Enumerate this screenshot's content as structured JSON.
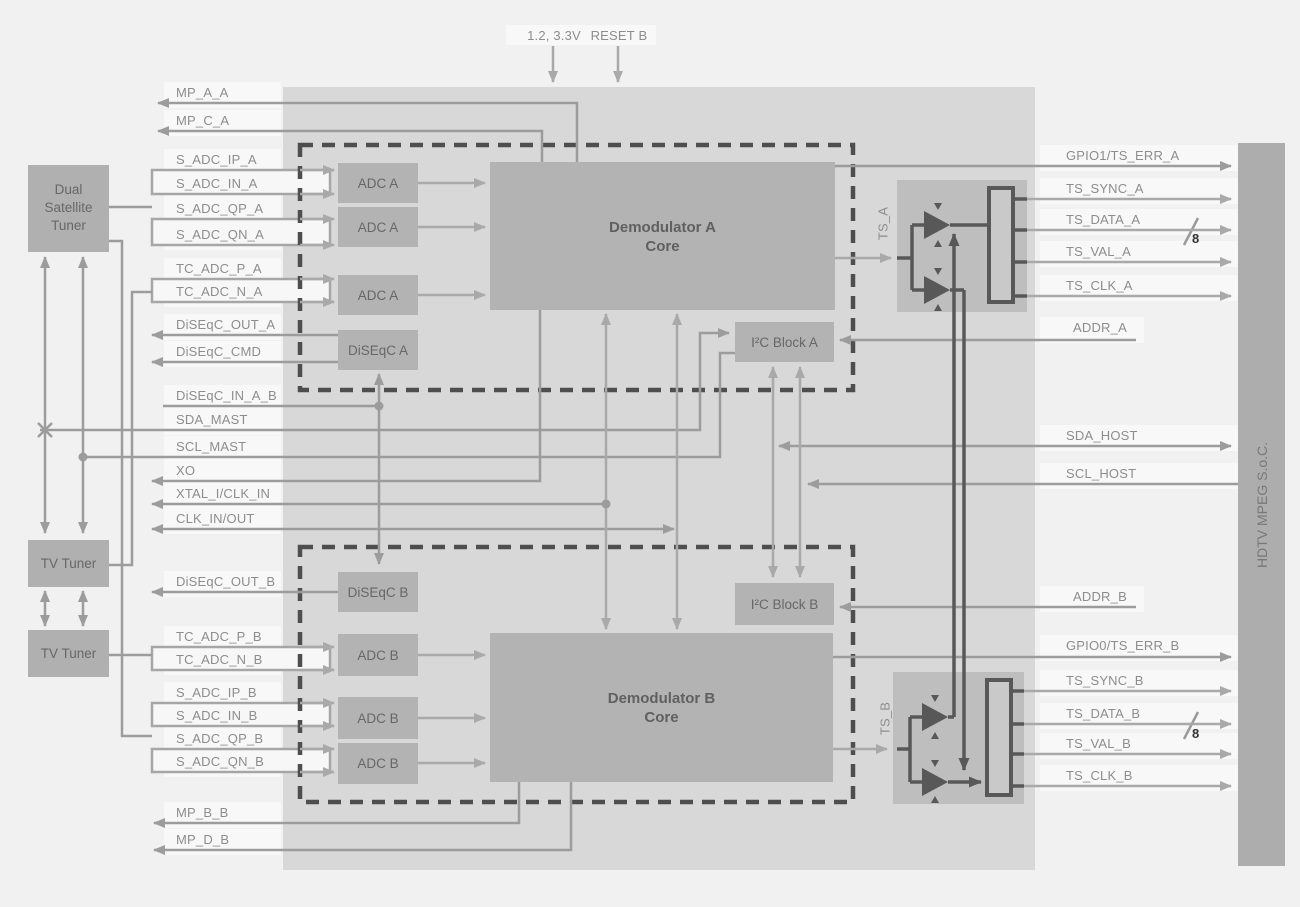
{
  "power": {
    "supply": "1.2, 3.3V",
    "reset": "RESET B"
  },
  "blocks": {
    "dual_satellite_tuner": "Dual\nSatellite\nTuner",
    "tv_tuner": "TV Tuner",
    "demodulator_a": "Demodulator A\nCore",
    "demodulator_b": "Demodulator B\nCore",
    "adc_a": "ADC A",
    "adc_b": "ADC B",
    "diseqc_a": "DiSEqC A",
    "diseqc_b": "DiSEqC B",
    "i2c_block_a": "I²C Block A",
    "i2c_block_b": "I²C Block B",
    "ts_a": "TS_A",
    "ts_b": "TS_B",
    "soc": "HDTV MPEG S.o.C."
  },
  "left_signals": [
    "MP_A_A",
    "MP_C_A",
    "S_ADC_IP_A",
    "S_ADC_IN_A",
    "S_ADC_QP_A",
    "S_ADC_QN_A",
    "TC_ADC_P_A",
    "TC_ADC_N_A",
    "DiSEqC_OUT_A",
    "DiSEqC_CMD",
    "DiSEqC_IN_A_B",
    "SDA_MAST",
    "SCL_MAST",
    "XO",
    "XTAL_I/CLK_IN",
    "CLK_IN/OUT",
    "DiSEqC_OUT_B",
    "TC_ADC_P_B",
    "TC_ADC_N_B",
    "S_ADC_IP_B",
    "S_ADC_IN_B",
    "S_ADC_QP_B",
    "S_ADC_QN_B",
    "MP_B_B",
    "MP_D_B"
  ],
  "right_signals": [
    "GPIO1/TS_ERR_A",
    "TS_SYNC_A",
    "TS_DATA_A",
    "TS_VAL_A",
    "TS_CLK_A",
    "ADDR_A",
    "SDA_HOST",
    "SCL_HOST",
    "ADDR_B",
    "GPIO0/TS_ERR_B",
    "TS_SYNC_B",
    "TS_DATA_B",
    "TS_VAL_B",
    "TS_CLK_B"
  ],
  "bus_width": "8",
  "colors": {
    "canvas_bg": "#f1f1f1",
    "chip_bg": "#d8d8d8",
    "block_fill": "#b3b3b3",
    "ts_mux_fill": "#bebebe",
    "soc_fill": "#adadad",
    "dashed_border": "#4e4e4e",
    "signal_line": "#9c9c9c",
    "light_line": "#a9a9a9",
    "dark_line": "#585858",
    "label_text": "#8d8d8d",
    "block_text": "#606060"
  }
}
